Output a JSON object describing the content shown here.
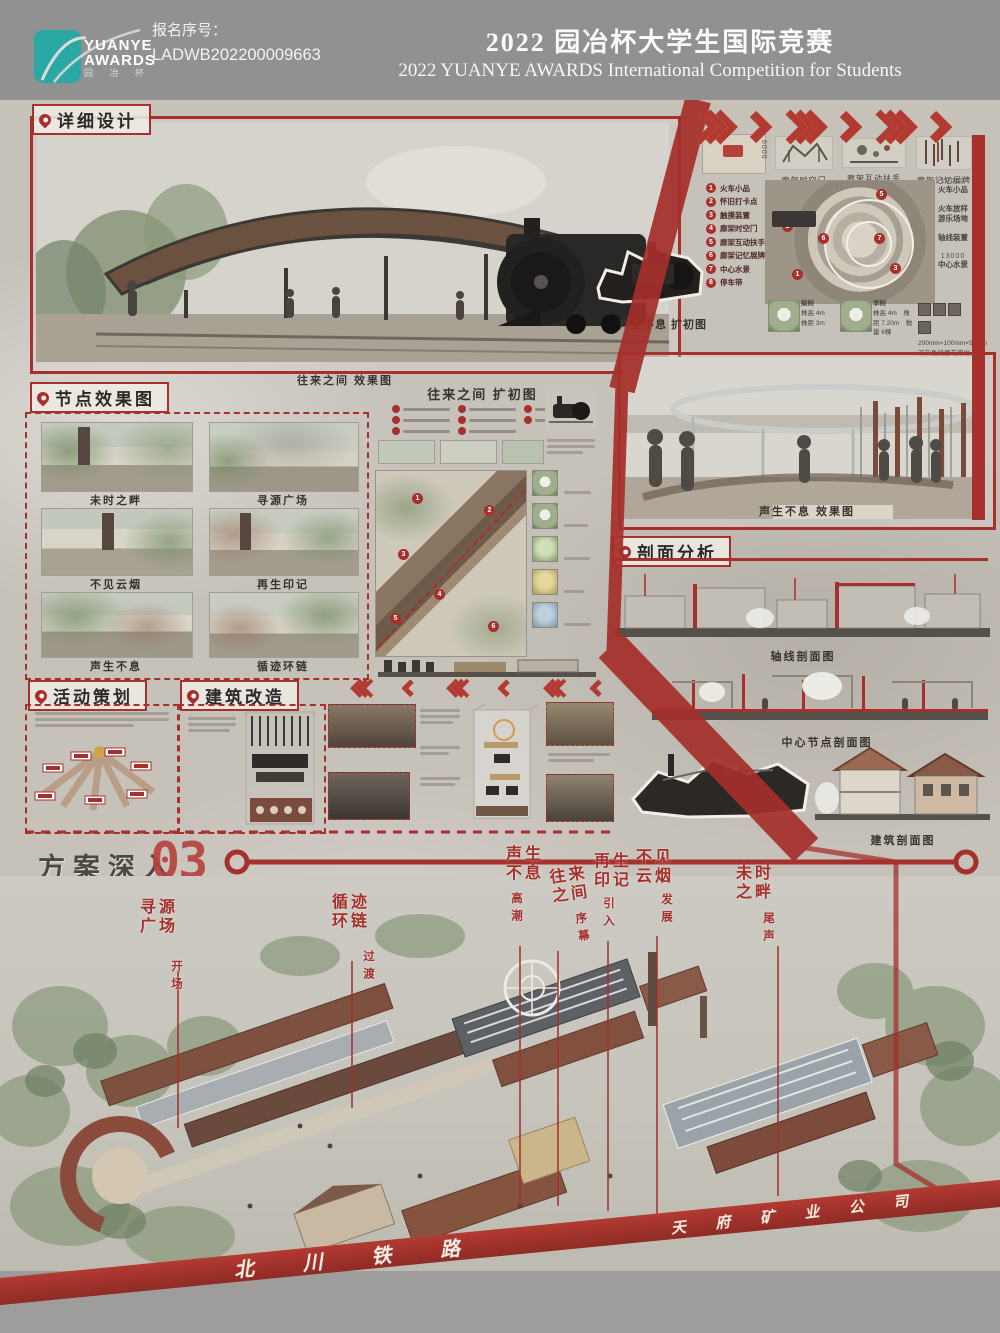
{
  "colors": {
    "accent_red": "#a5302c",
    "chevron_red": "#b23a31",
    "teal": "#2aa9a4",
    "header_gray": "#919191"
  },
  "header": {
    "logo": {
      "line1": "YUANYE",
      "line2": "AWARDS",
      "cn": "园 冶 杯"
    },
    "reg_label": "报名序号：",
    "reg_no": "LADWB202200009663",
    "title_cn": "2022 园冶杯大学生国际竞赛",
    "title_en": "2022 YUANYE AWARDS International Competition for  Students"
  },
  "poster": {
    "detail_design": {
      "label": "详细设计",
      "caption": "往来之间 效果图"
    },
    "expansion_plan": {
      "caption": "声生不息 扩初图",
      "legend": [
        {
          "n": "1",
          "t": "火车小品"
        },
        {
          "n": "2",
          "t": "怀旧打卡点"
        },
        {
          "n": "3",
          "t": "触摸装置"
        },
        {
          "n": "4",
          "t": "廊架时空门"
        },
        {
          "n": "5",
          "t": "廊架互动扶手"
        },
        {
          "n": "6",
          "t": "廊架记忆展牌"
        },
        {
          "n": "7",
          "t": "中心水景"
        },
        {
          "n": "8",
          "t": "停车带"
        }
      ],
      "top_diagrams": [
        {
          "caption": "廊架时空门",
          "dim": "6000"
        },
        {
          "caption": "廊架互动扶手",
          "dim": ""
        },
        {
          "caption": "廊架记忆展牌",
          "dim": "4000"
        }
      ],
      "side_items": [
        {
          "dim": "10000",
          "label": "火车小品"
        },
        {
          "dim": "",
          "label": "火车放样 游乐场地"
        },
        {
          "dim": "",
          "label": "轴线装置"
        },
        {
          "dim": "13000",
          "label": "中心水景"
        }
      ],
      "plants": [
        {
          "label": "梨树",
          "spec": "株高 4m　株距 3m"
        },
        {
          "label": "李树",
          "spec": "株高 4m　株距 7.20m　数量 6棵"
        }
      ],
      "paving": "200mm×100mm×50mm 深灰色烧面花岗岩人字铺"
    },
    "node_effects": {
      "label": "节点效果图",
      "items": [
        "未时之畔",
        "寻源广场",
        "不见云烟",
        "再生印记",
        "声生不息",
        "循迹环链"
      ]
    },
    "wanglai_plan": {
      "title": "往来之间 扩初图"
    },
    "shengsheng_render": {
      "caption": "声生不息 效果图"
    },
    "section_analysis": {
      "label": "剖面分析",
      "axis_caption": "轴线剖面图",
      "center_caption": "中心节点剖面图",
      "building_caption": "建筑剖面图"
    },
    "activity": {
      "label": "活动策划"
    },
    "renovation": {
      "label": "建筑改造"
    },
    "program": {
      "label": "方案深入",
      "number": "03"
    },
    "aerial": {
      "labels": [
        {
          "name": "寻源广场",
          "phase": "开场"
        },
        {
          "name": "循迹环链",
          "phase": "过渡"
        },
        {
          "name": "声生不息",
          "phase": "高潮"
        },
        {
          "name": "往来之间",
          "phase": "序幕"
        },
        {
          "name": "再生印记",
          "phase": "引入"
        },
        {
          "name": "不见云烟",
          "phase": "发展"
        },
        {
          "name": "未时之畔",
          "phase": "尾声"
        }
      ],
      "banner_railway": "北 川 铁 路",
      "banner_company": "天 府 矿 业 公 司"
    }
  }
}
